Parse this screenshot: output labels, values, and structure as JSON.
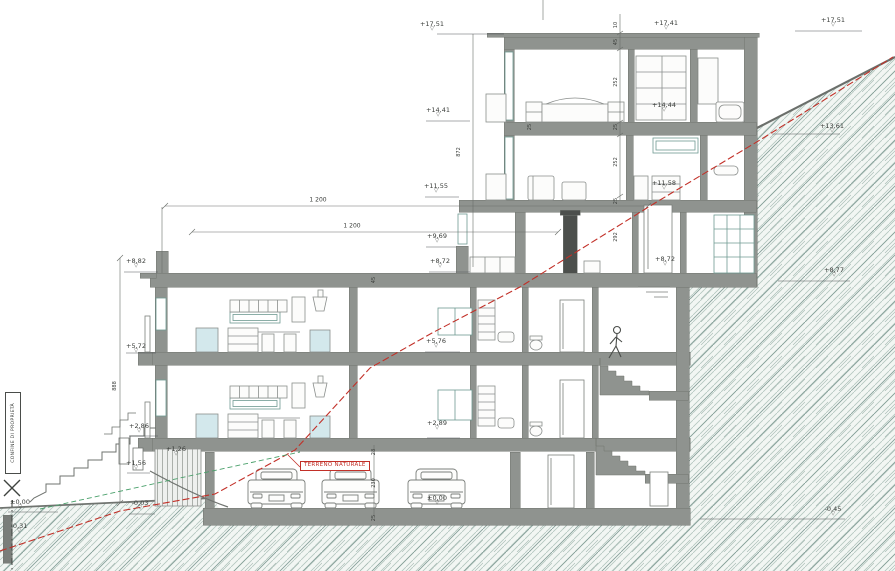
{
  "drawing": {
    "type": "architectural cross-section on hillside",
    "property_line_label": "CONFINE DI PROPRIETÀ",
    "terrain_label": "TERRENO NATURALE"
  },
  "icons": {
    "elevation_triangle": "▽"
  },
  "colors": {
    "wall_gray": "#8f938f",
    "terrain_red": "#c23028",
    "garden_green": "#4aa06b",
    "hatch_teal": "#9db5ae",
    "text": "#3a3d3a"
  },
  "elevation_markers": [
    {
      "text": "+17,51",
      "x": 432,
      "y": 21
    },
    {
      "text": "+17,41",
      "x": 666,
      "y": 20
    },
    {
      "text": "+17,51",
      "x": 833,
      "y": 17
    },
    {
      "text": "+14,41",
      "x": 438,
      "y": 107
    },
    {
      "text": "+14,44",
      "x": 664,
      "y": 102
    },
    {
      "text": "+13,61",
      "x": 832,
      "y": 123
    },
    {
      "text": "+11,55",
      "x": 436,
      "y": 183
    },
    {
      "text": "+11,58",
      "x": 664,
      "y": 180
    },
    {
      "text": "+9,69",
      "x": 437,
      "y": 233
    },
    {
      "text": "+8,82",
      "x": 136,
      "y": 258
    },
    {
      "text": "+8,72",
      "x": 440,
      "y": 258
    },
    {
      "text": "+8,72",
      "x": 665,
      "y": 256
    },
    {
      "text": "+8,77",
      "x": 834,
      "y": 267
    },
    {
      "text": "+5,72",
      "x": 136,
      "y": 343
    },
    {
      "text": "+5,76",
      "x": 436,
      "y": 338
    },
    {
      "text": "+2,86",
      "x": 139,
      "y": 423
    },
    {
      "text": "+2,89",
      "x": 437,
      "y": 420
    },
    {
      "text": "+1,26",
      "x": 176,
      "y": 446
    },
    {
      "text": "+1,56",
      "x": 136,
      "y": 460
    },
    {
      "text": "±0,00",
      "x": 20,
      "y": 499
    },
    {
      "text": "-0,03",
      "x": 140,
      "y": 500
    },
    {
      "text": "-0,31",
      "x": 19,
      "y": 523
    },
    {
      "text": "±0,00",
      "x": 437,
      "y": 495
    },
    {
      "text": "-0,45",
      "x": 833,
      "y": 506
    }
  ],
  "dimension_labels": [
    {
      "text": "1 200",
      "x": 318,
      "y": 200,
      "dir": "h"
    },
    {
      "text": "1 200",
      "x": 352,
      "y": 226,
      "dir": "h"
    },
    {
      "text": "872",
      "x": 459,
      "y": 152,
      "dir": "v"
    },
    {
      "text": "888",
      "x": 115,
      "y": 386,
      "dir": "v"
    },
    {
      "text": "10",
      "x": 616,
      "y": 25,
      "dir": "v"
    },
    {
      "text": "45",
      "x": 616,
      "y": 42,
      "dir": "v"
    },
    {
      "text": "252",
      "x": 616,
      "y": 82,
      "dir": "v"
    },
    {
      "text": "25",
      "x": 616,
      "y": 127,
      "dir": "v"
    },
    {
      "text": "252",
      "x": 616,
      "y": 162,
      "dir": "v"
    },
    {
      "text": "25",
      "x": 616,
      "y": 201,
      "dir": "v"
    },
    {
      "text": "292",
      "x": 616,
      "y": 237,
      "dir": "v"
    },
    {
      "text": "45",
      "x": 374,
      "y": 280,
      "dir": "v"
    },
    {
      "text": "28",
      "x": 374,
      "y": 452,
      "dir": "v"
    },
    {
      "text": "230",
      "x": 374,
      "y": 483,
      "dir": "v"
    },
    {
      "text": "25",
      "x": 374,
      "y": 518,
      "dir": "v"
    },
    {
      "text": "25",
      "x": 530,
      "y": 127,
      "dir": "v"
    }
  ]
}
